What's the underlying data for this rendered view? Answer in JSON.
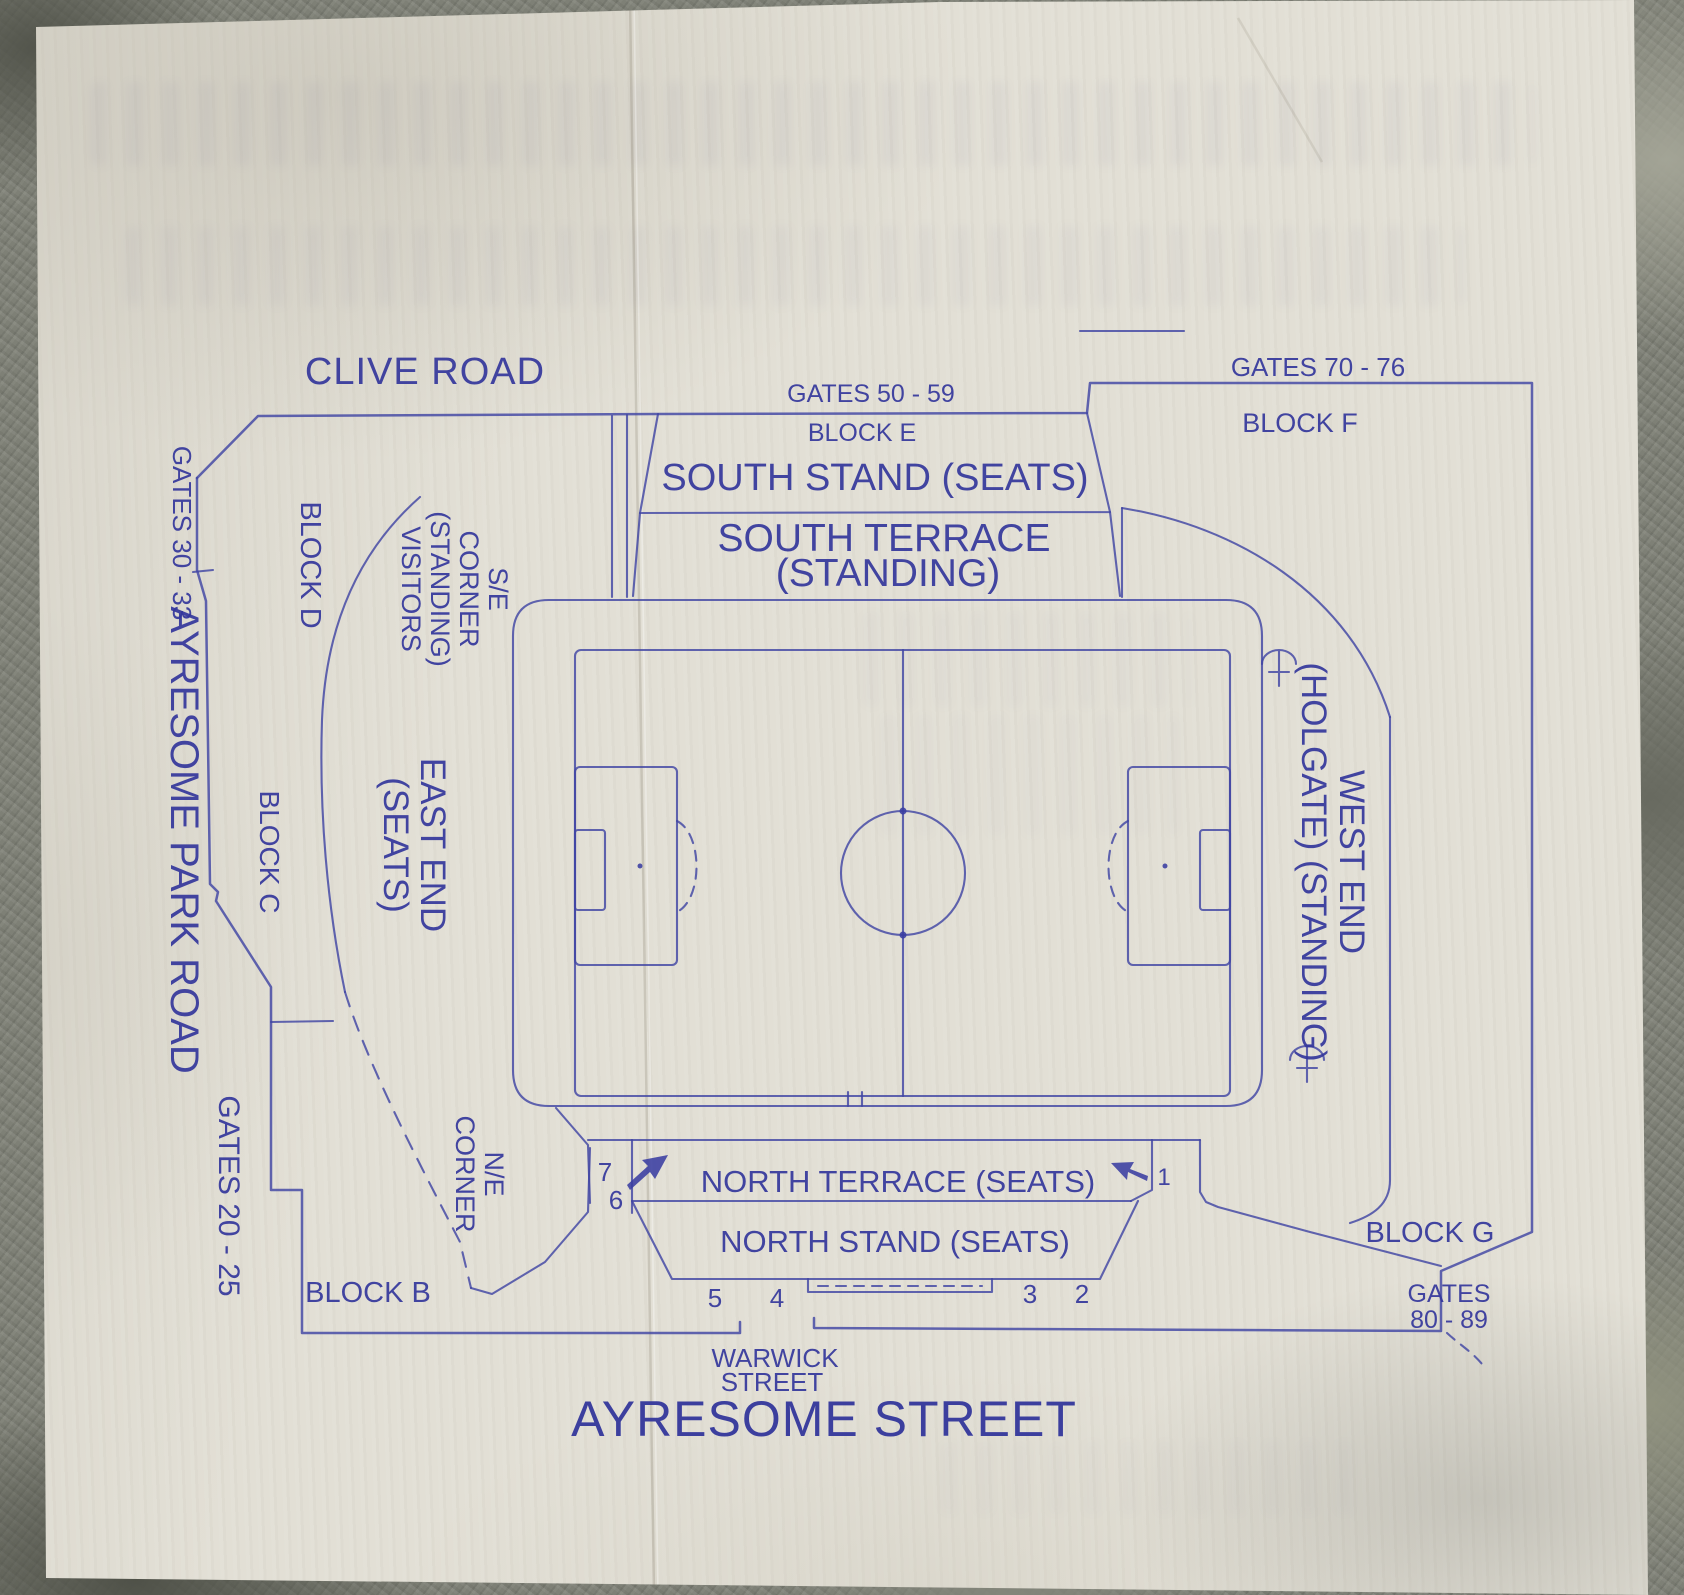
{
  "colors": {
    "ink_blue": "#34379c",
    "paper": "#e2dfd5",
    "stone_grey": "#7e8076"
  },
  "streets": {
    "clive_road": "CLIVE ROAD",
    "ayresome_park_road": "AYRESOME PARK ROAD",
    "warwick_street_line1": "WARWICK",
    "warwick_street_line2": "STREET",
    "ayresome_street": "AYRESOME STREET"
  },
  "gates": {
    "g30_33": "GATES 30 - 33",
    "g50_59": "GATES 50 - 59",
    "g70_76": "GATES 70 - 76",
    "g20_25": "GATES 20 - 25",
    "g80_89_line1": "GATES",
    "g80_89_line2": "80 - 89"
  },
  "blocks": {
    "b": "BLOCK B",
    "c": "BLOCK C",
    "d": "BLOCK D",
    "e": "BLOCK E",
    "f": "BLOCK F",
    "g": "BLOCK G"
  },
  "stands": {
    "south_stand": "SOUTH STAND (SEATS)",
    "south_terrace_line1": "SOUTH TERRACE",
    "south_terrace_line2": "(STANDING)",
    "east_end_line1": "EAST END",
    "east_end_line2": "(SEATS)",
    "west_end_line1": "WEST END",
    "west_end_line2": "(HOLGATE) (STANDING)",
    "north_terrace": "NORTH TERRACE (SEATS)",
    "north_stand": "NORTH STAND (SEATS)",
    "se_corner_line1": "S/E",
    "se_corner_line2": "CORNER",
    "se_corner_line3": "(STANDING)",
    "se_corner_line4": "VISITORS",
    "ne_corner_line1": "N/E",
    "ne_corner_line2": "CORNER"
  },
  "entrances": {
    "n1": "1",
    "n2": "2",
    "n3": "3",
    "n4": "4",
    "n5": "5",
    "n6": "6",
    "n7": "7"
  },
  "icons": {
    "corner_structure": "umbrella-icon",
    "direction_marker": "arrow-icon"
  }
}
